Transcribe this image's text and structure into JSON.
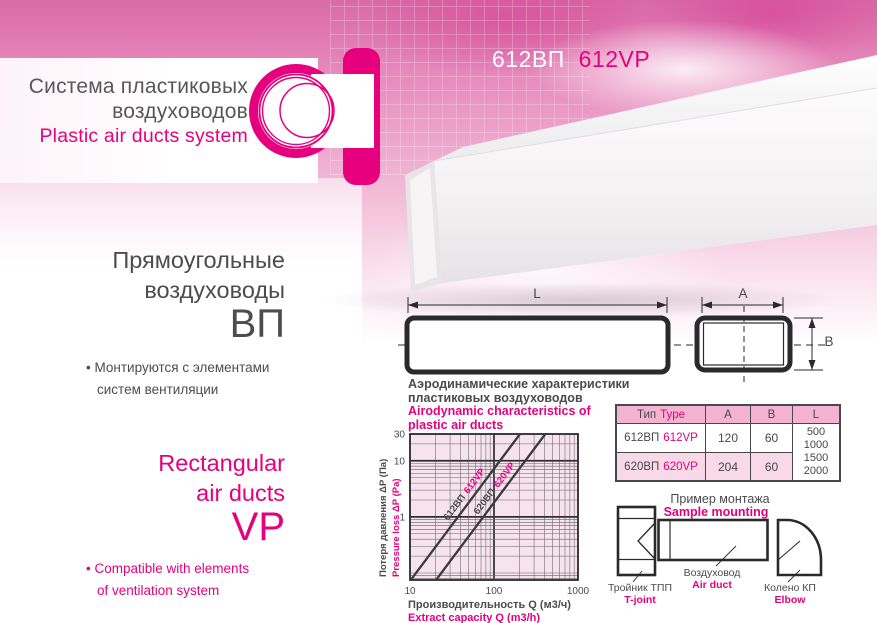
{
  "colors": {
    "accent": "#e6007e",
    "text_dark": "#4b4b4d",
    "sky_pink": "#d96aa9",
    "table_header_bg": "#f5b3d2",
    "table_alt_row_bg": "#f9d9e8",
    "plot_bg": "#f7e3ee"
  },
  "brand": {
    "title_ru_line1": "Система пластиковых",
    "title_ru_line2": "воздуховодов",
    "title_en": "Plastic air ducts system"
  },
  "product_title": {
    "ru": "612ВП",
    "en": "612VP"
  },
  "left_panel": {
    "bullet_mark": "•",
    "ru_heading_line1": "Прямоугольные",
    "ru_heading_line2": "воздуховоды",
    "ru_code": "ВП",
    "ru_bullet_line1": "Монтируются с элементами",
    "ru_bullet_line2": "систем вентиляции",
    "en_heading_line1": "Rectangular",
    "en_heading_line2": "air ducts",
    "en_code": "VP",
    "en_bullet_line1": "Compatible with elements",
    "en_bullet_line2": "of ventilation system"
  },
  "dimensions": {
    "l": "L",
    "a": "A",
    "b": "B"
  },
  "chart_heading": {
    "ru_line1": "Аэродинамические характеристики",
    "ru_line2": "пластиковых воздуховодов",
    "en_line1": "Airodynamic characteristics of",
    "en_line2": "plastic air ducts"
  },
  "chart_data": {
    "type": "line",
    "x_scale": "log",
    "y_scale": "log",
    "xlim": [
      10,
      1000
    ],
    "ylim": [
      0.075,
      30
    ],
    "x_ticks": [
      10,
      100,
      1000
    ],
    "y_ticks": [
      30,
      10,
      1
    ],
    "grid": "log-minor-and-major",
    "xlabel_ru": "Производительность Q (м3/ч)",
    "xlabel_en": "Extract capacity Q (m3/h)",
    "ylabel_ru": "Потеря давления ΔP (Па)",
    "ylabel_en": "Pressure loss ΔP (Pa)",
    "series": [
      {
        "name_ru": "612ВП",
        "name_en": "612VP",
        "points": [
          [
            10,
            0.072
          ],
          [
            100,
            7.2
          ],
          [
            204,
            30
          ]
        ]
      },
      {
        "name_ru": "620ВП",
        "name_en": "620VP",
        "points": [
          [
            20,
            0.072
          ],
          [
            100,
            1.8
          ],
          [
            408,
            30
          ]
        ]
      }
    ]
  },
  "table": {
    "header": {
      "type_ru": "Тип",
      "type_en": "Type",
      "a": "A",
      "b": "B",
      "l": "L"
    },
    "rows": [
      {
        "ru": "612ВП",
        "en": "612VP",
        "a": "120",
        "b": "60"
      },
      {
        "ru": "620ВП",
        "en": "620VP",
        "a": "204",
        "b": "60"
      }
    ],
    "l_values": [
      "500",
      "1000",
      "1500",
      "2000"
    ]
  },
  "mounting": {
    "title_ru": "Пример монтажа",
    "title_en": "Sample mounting",
    "tjoint_ru": "Тройник ТПП",
    "tjoint_en": "T-joint",
    "duct_ru": "Воздуховод",
    "duct_en": "Air duct",
    "elbow_ru": "Колено КП",
    "elbow_en": "Elbow"
  }
}
